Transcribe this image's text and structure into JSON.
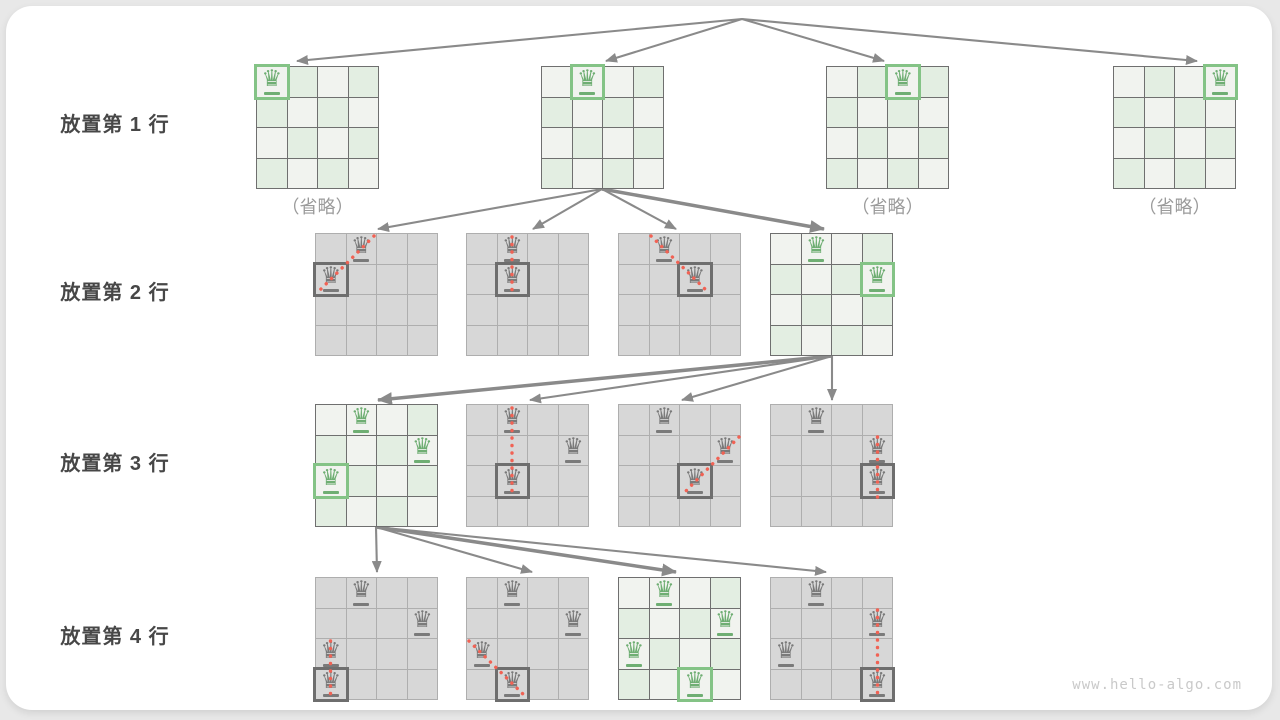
{
  "page": {
    "watermark": "www.hello-algo.com",
    "background": "#e8e8e8",
    "card_background": "#ffffff"
  },
  "colors": {
    "arrow": "#8a8a8a",
    "label_text": "#474747",
    "caption_text": "#9b9b9b",
    "watermark_text": "#c9c9c9",
    "green_cell": "#e3eee2",
    "light_cell": "#f1f3ef",
    "gray_cell": "#d7d7d7",
    "green_grid": "#6f6f6f",
    "gray_grid": "#aeaeae",
    "green_queen": "#6fae73",
    "gray_queen": "#7a7a7a",
    "green_box": "#84c386",
    "gray_box": "#6e6e6e",
    "conflict_dot": "#f16254"
  },
  "icons": {
    "queen_glyph": "♛"
  },
  "geometry": {
    "board_size": 123,
    "grid_n": 4
  },
  "rows": [
    {
      "label": "放置第 1 行",
      "boards": [
        {
          "name": "r1b1",
          "x": 256,
          "y": 66,
          "theme": "green",
          "queens": [
            {
              "r": 0,
              "c": 0,
              "box": true
            }
          ],
          "caption": "（省略）"
        },
        {
          "name": "r1b2",
          "x": 541,
          "y": 66,
          "theme": "green",
          "queens": [
            {
              "r": 0,
              "c": 1,
              "box": true
            }
          ]
        },
        {
          "name": "r1b3",
          "x": 826,
          "y": 66,
          "theme": "green",
          "queens": [
            {
              "r": 0,
              "c": 2,
              "box": true
            }
          ],
          "caption": "（省略）"
        },
        {
          "name": "r1b4",
          "x": 1113,
          "y": 66,
          "theme": "green",
          "queens": [
            {
              "r": 0,
              "c": 3,
              "box": true
            }
          ],
          "caption": "（省略）"
        }
      ]
    },
    {
      "label": "放置第 2 行",
      "boards": [
        {
          "name": "r2b1",
          "x": 315,
          "y": 233,
          "theme": "gray",
          "queens": [
            {
              "r": 0,
              "c": 1
            },
            {
              "r": 1,
              "c": 0,
              "box": true
            }
          ],
          "conflict": {
            "x1": 59,
            "y1": 3,
            "x2": 3,
            "y2": 59
          }
        },
        {
          "name": "r2b2",
          "x": 466,
          "y": 233,
          "theme": "gray",
          "queens": [
            {
              "r": 0,
              "c": 1
            },
            {
              "r": 1,
              "c": 1,
              "box": true
            }
          ],
          "conflict": {
            "x1": 46,
            "y1": 4,
            "x2": 46,
            "y2": 64
          }
        },
        {
          "name": "r2b3",
          "x": 618,
          "y": 233,
          "theme": "gray",
          "queens": [
            {
              "r": 0,
              "c": 1
            },
            {
              "r": 1,
              "c": 2,
              "box": true
            }
          ],
          "conflict": {
            "x1": 33,
            "y1": 3,
            "x2": 91,
            "y2": 60
          }
        },
        {
          "name": "r2b4",
          "x": 770,
          "y": 233,
          "theme": "green",
          "queens": [
            {
              "r": 0,
              "c": 1
            },
            {
              "r": 1,
              "c": 3,
              "box": true
            }
          ]
        }
      ]
    },
    {
      "label": "放置第 3 行",
      "boards": [
        {
          "name": "r3b1",
          "x": 315,
          "y": 404,
          "theme": "green",
          "queens": [
            {
              "r": 0,
              "c": 1
            },
            {
              "r": 1,
              "c": 3
            },
            {
              "r": 2,
              "c": 0,
              "box": true
            }
          ]
        },
        {
          "name": "r3b2",
          "x": 466,
          "y": 404,
          "theme": "gray",
          "queens": [
            {
              "r": 0,
              "c": 1
            },
            {
              "r": 1,
              "c": 3
            },
            {
              "r": 2,
              "c": 1,
              "box": true
            }
          ],
          "conflict": {
            "x1": 46,
            "y1": 4,
            "x2": 46,
            "y2": 94
          }
        },
        {
          "name": "r3b3",
          "x": 618,
          "y": 404,
          "theme": "gray",
          "queens": [
            {
              "r": 0,
              "c": 1
            },
            {
              "r": 1,
              "c": 3
            },
            {
              "r": 2,
              "c": 2,
              "box": true
            }
          ],
          "conflict": {
            "x1": 121,
            "y1": 33,
            "x2": 64,
            "y2": 91
          }
        },
        {
          "name": "r3b4",
          "x": 770,
          "y": 404,
          "theme": "gray",
          "queens": [
            {
              "r": 0,
              "c": 1
            },
            {
              "r": 1,
              "c": 3
            },
            {
              "r": 2,
              "c": 3,
              "box": true
            }
          ],
          "conflict": {
            "x1": 107.5,
            "y1": 33,
            "x2": 107.5,
            "y2": 94
          }
        }
      ]
    },
    {
      "label": "放置第 4 行",
      "boards": [
        {
          "name": "r4b1",
          "x": 315,
          "y": 577,
          "theme": "gray",
          "queens": [
            {
              "r": 0,
              "c": 1
            },
            {
              "r": 1,
              "c": 3
            },
            {
              "r": 2,
              "c": 0
            },
            {
              "r": 3,
              "c": 0,
              "box": true
            }
          ],
          "conflict": {
            "x1": 15.5,
            "y1": 64,
            "x2": 15.5,
            "y2": 121
          }
        },
        {
          "name": "r4b2",
          "x": 466,
          "y": 577,
          "theme": "gray",
          "queens": [
            {
              "r": 0,
              "c": 1
            },
            {
              "r": 1,
              "c": 3
            },
            {
              "r": 2,
              "c": 0
            },
            {
              "r": 3,
              "c": 1,
              "box": true
            }
          ],
          "conflict": {
            "x1": 3,
            "y1": 64,
            "x2": 60,
            "y2": 120
          }
        },
        {
          "name": "r4b3",
          "x": 618,
          "y": 577,
          "theme": "green",
          "queens": [
            {
              "r": 0,
              "c": 1
            },
            {
              "r": 1,
              "c": 3
            },
            {
              "r": 2,
              "c": 0
            },
            {
              "r": 3,
              "c": 2,
              "box": true
            }
          ]
        },
        {
          "name": "r4b4",
          "x": 770,
          "y": 577,
          "theme": "gray",
          "queens": [
            {
              "r": 0,
              "c": 1
            },
            {
              "r": 1,
              "c": 3
            },
            {
              "r": 2,
              "c": 0
            },
            {
              "r": 3,
              "c": 3,
              "box": true
            }
          ],
          "conflict": {
            "x1": 107.5,
            "y1": 33,
            "x2": 107.5,
            "y2": 121
          }
        }
      ]
    }
  ],
  "edges": {
    "root": {
      "x": 742,
      "y": 19
    },
    "list": [
      {
        "x1": 742,
        "y1": 19,
        "x2": 297,
        "y2": 61,
        "bold": false
      },
      {
        "x1": 742,
        "y1": 19,
        "x2": 606,
        "y2": 61,
        "bold": false
      },
      {
        "x1": 742,
        "y1": 19,
        "x2": 884,
        "y2": 61,
        "bold": false
      },
      {
        "x1": 742,
        "y1": 19,
        "x2": 1197,
        "y2": 61,
        "bold": false
      },
      {
        "x1": 602,
        "y1": 189,
        "x2": 378,
        "y2": 229,
        "bold": false
      },
      {
        "x1": 602,
        "y1": 189,
        "x2": 533,
        "y2": 229,
        "bold": false
      },
      {
        "x1": 602,
        "y1": 189,
        "x2": 676,
        "y2": 229,
        "bold": false
      },
      {
        "x1": 602,
        "y1": 189,
        "x2": 824,
        "y2": 229,
        "bold": true
      },
      {
        "x1": 832,
        "y1": 356,
        "x2": 378,
        "y2": 400,
        "bold": true
      },
      {
        "x1": 832,
        "y1": 356,
        "x2": 530,
        "y2": 400,
        "bold": false
      },
      {
        "x1": 832,
        "y1": 356,
        "x2": 682,
        "y2": 400,
        "bold": false
      },
      {
        "x1": 832,
        "y1": 356,
        "x2": 832,
        "y2": 400,
        "bold": false
      },
      {
        "x1": 376,
        "y1": 527,
        "x2": 377,
        "y2": 572,
        "bold": false
      },
      {
        "x1": 376,
        "y1": 527,
        "x2": 532,
        "y2": 572,
        "bold": false
      },
      {
        "x1": 376,
        "y1": 527,
        "x2": 676,
        "y2": 572,
        "bold": true
      },
      {
        "x1": 376,
        "y1": 527,
        "x2": 826,
        "y2": 572,
        "bold": false
      }
    ]
  }
}
